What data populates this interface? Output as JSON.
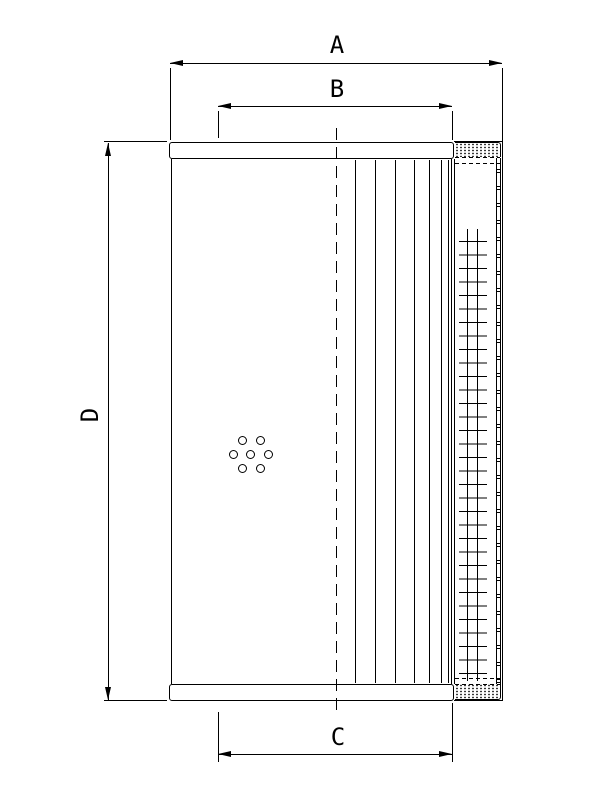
{
  "dimensions": {
    "a": {
      "label": "A"
    },
    "b": {
      "label": "B"
    },
    "c": {
      "label": "C"
    },
    "d": {
      "label": "D"
    }
  },
  "colors": {
    "line": "#000000",
    "background": "#ffffff"
  }
}
